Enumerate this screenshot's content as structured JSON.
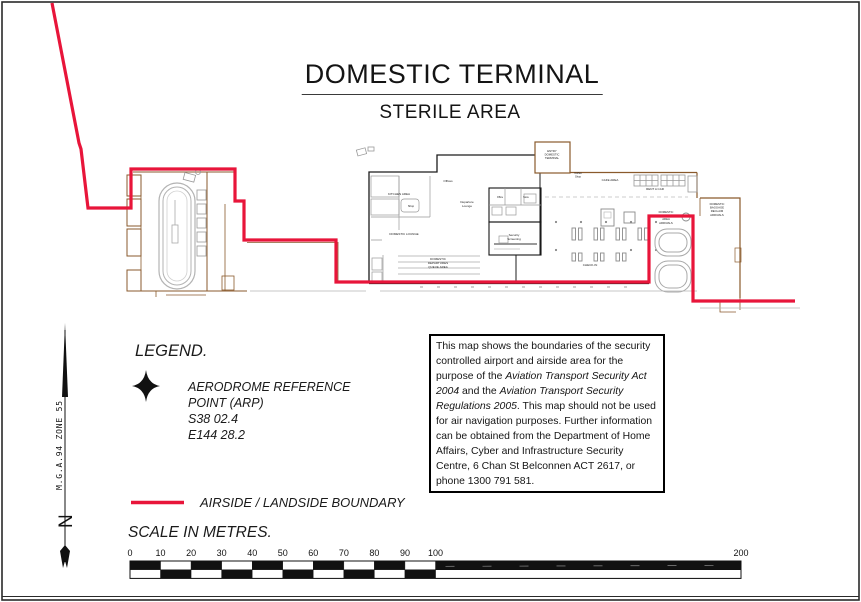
{
  "page": {
    "title": "DOMESTIC TERMINAL",
    "subtitle": "STERILE AREA"
  },
  "legend": {
    "heading": "LEGEND.",
    "arp": {
      "label_line1": "AERODROME REFERENCE",
      "label_line2": "POINT (ARP)",
      "latitude": "S38 02.4",
      "longitude": "E144 28.2"
    },
    "boundary_label": "AIRSIDE / LANDSIDE BOUNDARY",
    "scale_heading": "SCALE IN METRES."
  },
  "north_arrow": {
    "grid_label": "M.G.A.94 ZONE 55",
    "north_letter": "N"
  },
  "notice_box": {
    "segments": [
      {
        "text": "This map shows the boundaries of the security controlled airport and airside area for the purpose of the ",
        "italic": false
      },
      {
        "text": "Aviation Transport Security Act 2004",
        "italic": true
      },
      {
        "text": " and the ",
        "italic": false
      },
      {
        "text": "Aviation Transport Security Regulations 2005",
        "italic": true
      },
      {
        "text": ". This map should not be used for air navigation purposes. Further information can be obtained from the Department of Home Affairs, Cyber and Infrastructure Security Centre, 6 Chan St Belconnen ACT 2617, or phone 1300 791 581.",
        "italic": false
      }
    ]
  },
  "scale_bar": {
    "tick_labels": [
      "0",
      "10",
      "20",
      "30",
      "40",
      "50",
      "60",
      "70",
      "80",
      "90",
      "100"
    ],
    "end_label": "200",
    "geom": {
      "x0": 130,
      "cell": 30.55,
      "y": 561,
      "rh": 8.7
    }
  },
  "map": {
    "colors": {
      "boundary": "#e8153a",
      "wall": "#8a5a2c",
      "detail": "#999999",
      "black_wall": "#1c1c1c"
    },
    "boundary_points": [
      [
        52,
        3
      ],
      [
        79,
        143
      ],
      [
        81,
        149
      ],
      [
        88,
        208
      ],
      [
        131,
        208
      ],
      [
        131,
        169
      ],
      [
        235,
        169
      ],
      [
        235,
        201
      ],
      [
        244,
        201
      ],
      [
        244,
        240
      ],
      [
        336,
        240
      ],
      [
        336,
        282
      ],
      [
        649,
        282
      ],
      [
        649,
        216
      ],
      [
        693,
        216
      ],
      [
        693,
        301
      ],
      [
        795,
        301
      ]
    ],
    "labels": [
      {
        "t": "KITCHEN AREA",
        "x": 399,
        "y": 195,
        "s": 3
      },
      {
        "t": "Offices",
        "x": 448,
        "y": 182,
        "s": 3
      },
      {
        "t": "Departure\nLounge",
        "x": 467,
        "y": 203,
        "s": 3
      },
      {
        "t": "Shop",
        "x": 411,
        "y": 207,
        "s": 2.7
      },
      {
        "t": "DOMESTIC LOUNGE",
        "x": 404,
        "y": 235,
        "s": 3
      },
      {
        "t": "Office",
        "x": 500,
        "y": 198,
        "s": 2.4
      },
      {
        "t": "Store",
        "x": 526,
        "y": 198,
        "s": 2.4
      },
      {
        "t": "Security\nScreening",
        "x": 514,
        "y": 236,
        "s": 3
      },
      {
        "t": "DOMESTIC\nDEPARTURES\nQUEUE AREA",
        "x": 438,
        "y": 260,
        "s": 3,
        "dy": 3.9
      },
      {
        "t": "CHECK-IN",
        "x": 590,
        "y": 266,
        "s": 3
      },
      {
        "t": "CAFE AREA",
        "x": 610,
        "y": 181,
        "s": 3
      },
      {
        "t": "RENT A CAR",
        "x": 655,
        "y": 190,
        "s": 3
      },
      {
        "t": "Coffee\nShop",
        "x": 578,
        "y": 174,
        "s": 2.6
      },
      {
        "t": "ENTRY\nDOMESTIC\nTERMINAL",
        "x": 552,
        "y": 152,
        "s": 2.8,
        "dy": 3.5
      },
      {
        "t": "DOMESTIC\nBAGGAGE\nAREA\nARRIVALS",
        "x": 666,
        "y": 213,
        "s": 2.8,
        "dy": 3.6
      },
      {
        "t": "DOMESTIC\nBAGGAGE\nRECLAIM\nARRIVALS",
        "x": 717,
        "y": 205,
        "s": 2.8,
        "dy": 3.6
      }
    ]
  }
}
